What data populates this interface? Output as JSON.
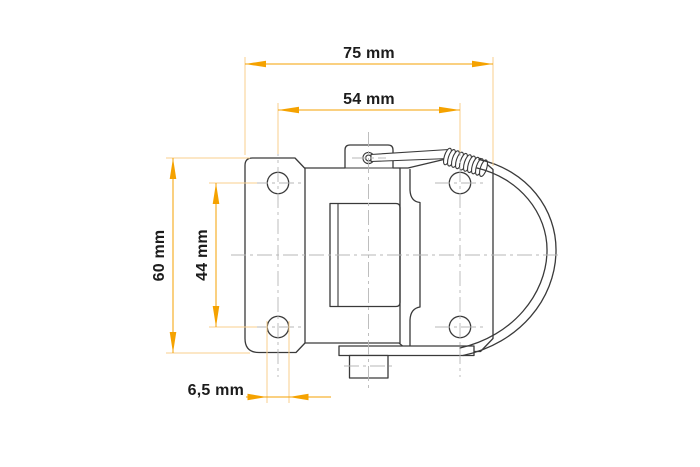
{
  "page": {
    "background_color": "#ffffff"
  },
  "drawing": {
    "title": "Toggle latch dimensional drawing (side view)",
    "subject": "spring toggle latch with wire bail, mounting plate with four holes",
    "colors": {
      "part_line": "#3a3a3a",
      "centerline": "#b7b7b7",
      "dimension_accent": "#f5a200",
      "extension_line": "#f8cf8d",
      "text": "#1c1c1c"
    },
    "dimensions": [
      {
        "id": "overall-width",
        "label": "75 mm",
        "value": 75,
        "unit": "mm",
        "orientation": "horizontal"
      },
      {
        "id": "hole-spacing-width",
        "label": "54 mm",
        "value": 54,
        "unit": "mm",
        "orientation": "horizontal"
      },
      {
        "id": "overall-height",
        "label": "60 mm",
        "value": 60,
        "unit": "mm",
        "orientation": "vertical"
      },
      {
        "id": "hole-spacing-height",
        "label": "44 mm",
        "value": 44,
        "unit": "mm",
        "orientation": "vertical"
      },
      {
        "id": "hole-diameter",
        "label": "6,5 mm",
        "value": 6.5,
        "unit": "mm",
        "orientation": "horizontal"
      }
    ]
  }
}
